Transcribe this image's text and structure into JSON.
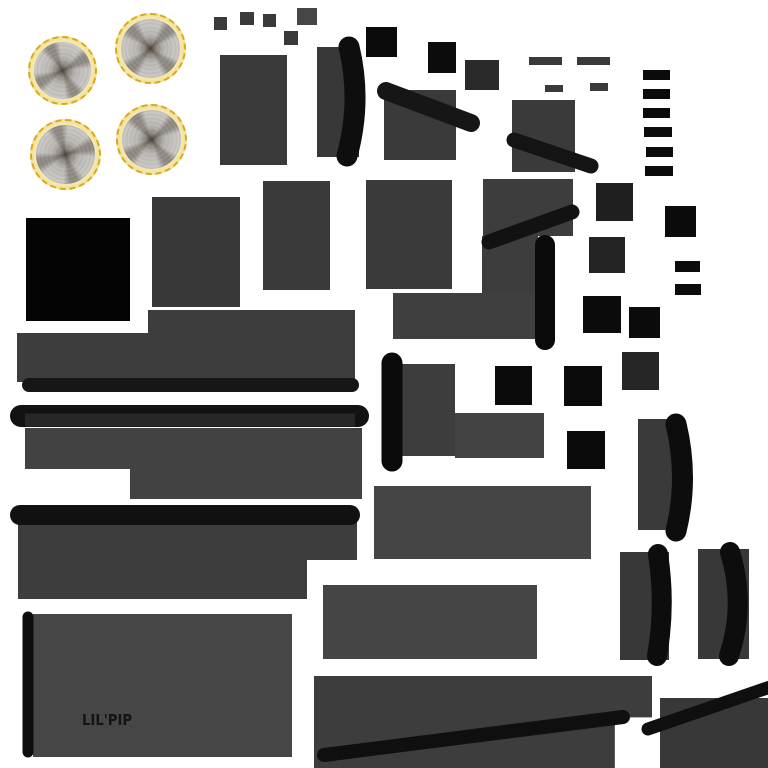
{
  "canvas": {
    "width": 768,
    "height": 768,
    "background": "#ffffff"
  },
  "label": {
    "text": "LIL'PIP",
    "color": "#141414"
  },
  "palette": {
    "panel_gray": "#3a3a3a",
    "panel_mid": "#3d3d3d",
    "panel_light": "#454545",
    "trim_black": "#0f0f0f",
    "wheel_gold": "#d9a91c",
    "wheel_rim": "#f0dc8a",
    "bg": "#ffffff"
  },
  "wheels": [
    {
      "name": "wheel-texture-1",
      "x": 28,
      "y": 36,
      "d": 69,
      "rotate": 12
    },
    {
      "name": "wheel-texture-2",
      "x": 115,
      "y": 13,
      "d": 71,
      "rotate": -6
    },
    {
      "name": "wheel-texture-3",
      "x": 30,
      "y": 119,
      "d": 71,
      "rotate": 22
    },
    {
      "name": "wheel-texture-4",
      "x": 116,
      "y": 104,
      "d": 71,
      "rotate": 3
    }
  ],
  "shapes": [
    {
      "name": "chip-square-1",
      "x": 214,
      "y": 17,
      "w": 13,
      "h": 13,
      "c": "#3a3a3a"
    },
    {
      "name": "chip-square-2",
      "x": 240,
      "y": 12,
      "w": 14,
      "h": 13,
      "c": "#3a3a3a"
    },
    {
      "name": "chip-square-3",
      "x": 263,
      "y": 14,
      "w": 13,
      "h": 13,
      "c": "#3a3a3a"
    },
    {
      "name": "chip-square-4",
      "x": 297,
      "y": 8,
      "w": 20,
      "h": 17,
      "c": "#464646"
    },
    {
      "name": "chip-square-5",
      "x": 284,
      "y": 31,
      "w": 14,
      "h": 14,
      "c": "#3a3a3a"
    },
    {
      "name": "black-square-1",
      "x": 366,
      "y": 27,
      "w": 31,
      "h": 30,
      "c": "#0a0a0a"
    },
    {
      "name": "black-square-2",
      "x": 428,
      "y": 42,
      "w": 28,
      "h": 31,
      "c": "#0c0c0c"
    },
    {
      "name": "dark-square-1",
      "x": 465,
      "y": 60,
      "w": 34,
      "h": 30,
      "c": "#2a2a2a"
    },
    {
      "name": "strip-bar-1",
      "x": 529,
      "y": 57,
      "w": 33,
      "h": 8,
      "c": "#3a3a3a"
    },
    {
      "name": "strip-bar-2",
      "x": 577,
      "y": 57,
      "w": 33,
      "h": 8,
      "c": "#3a3a3a"
    },
    {
      "name": "strip-bar-3",
      "x": 545,
      "y": 85,
      "w": 18,
      "h": 7,
      "c": "#3a3a3a"
    },
    {
      "name": "strip-bar-4",
      "x": 590,
      "y": 83,
      "w": 18,
      "h": 8,
      "c": "#3a3a3a"
    },
    {
      "name": "ladder-bar-1",
      "x": 643,
      "y": 70,
      "w": 27,
      "h": 10,
      "c": "#0b0b0b"
    },
    {
      "name": "ladder-bar-2",
      "x": 643,
      "y": 89,
      "w": 27,
      "h": 10,
      "c": "#0b0b0b"
    },
    {
      "name": "ladder-bar-3",
      "x": 643,
      "y": 108,
      "w": 27,
      "h": 10,
      "c": "#0b0b0b"
    },
    {
      "name": "ladder-bar-4",
      "x": 644,
      "y": 127,
      "w": 28,
      "h": 10,
      "c": "#0b0b0b"
    },
    {
      "name": "ladder-bar-5",
      "x": 646,
      "y": 147,
      "w": 27,
      "h": 10,
      "c": "#0b0b0b"
    },
    {
      "name": "ladder-bar-6",
      "x": 645,
      "y": 166,
      "w": 28,
      "h": 10,
      "c": "#0b0b0b"
    },
    {
      "name": "panel-tall-1",
      "x": 220,
      "y": 55,
      "w": 67,
      "h": 110,
      "c": "#3a3a3a"
    },
    {
      "name": "crescent-panel-top",
      "x": 317,
      "y": 47,
      "w": 42,
      "h": 110,
      "c": "#383838"
    },
    {
      "name": "panel-square-1",
      "x": 384,
      "y": 90,
      "w": 72,
      "h": 70,
      "c": "#3a3a3a"
    },
    {
      "name": "panel-square-2",
      "x": 512,
      "y": 100,
      "w": 63,
      "h": 72,
      "c": "#3a3a3a"
    },
    {
      "name": "dark-square-2",
      "x": 596,
      "y": 183,
      "w": 37,
      "h": 38,
      "c": "#1f1f1f"
    },
    {
      "name": "black-square-3",
      "x": 665,
      "y": 206,
      "w": 31,
      "h": 31,
      "c": "#0b0b0b"
    },
    {
      "name": "dark-square-3",
      "x": 589,
      "y": 237,
      "w": 36,
      "h": 36,
      "c": "#242424"
    },
    {
      "name": "panel-tall-2",
      "x": 152,
      "y": 197,
      "w": 88,
      "h": 110,
      "c": "#383838"
    },
    {
      "name": "black-panel",
      "x": 26,
      "y": 218,
      "w": 104,
      "h": 103,
      "c": "#040404"
    },
    {
      "name": "panel-tall-3",
      "x": 263,
      "y": 181,
      "w": 67,
      "h": 109,
      "c": "#3a3a3a"
    },
    {
      "name": "panel-tall-4",
      "x": 366,
      "y": 180,
      "w": 86,
      "h": 109,
      "c": "#3a3a3a"
    },
    {
      "name": "panel-l-top",
      "x": 483,
      "y": 179,
      "w": 90,
      "h": 57,
      "c": "#3d3d3d"
    },
    {
      "name": "panel-l-stem",
      "x": 482,
      "y": 236,
      "w": 56,
      "h": 102,
      "c": "#3d3d3d"
    },
    {
      "name": "panel-wide-1",
      "x": 393,
      "y": 293,
      "w": 145,
      "h": 46,
      "c": "#3f3f3f"
    },
    {
      "name": "black-square-4",
      "x": 583,
      "y": 296,
      "w": 38,
      "h": 37,
      "c": "#0b0b0b"
    },
    {
      "name": "black-square-5",
      "x": 629,
      "y": 307,
      "w": 31,
      "h": 31,
      "c": "#0b0b0b"
    },
    {
      "name": "black-bar-1",
      "x": 675,
      "y": 261,
      "w": 25,
      "h": 11,
      "c": "#0b0b0b"
    },
    {
      "name": "black-bar-2",
      "x": 675,
      "y": 284,
      "w": 26,
      "h": 11,
      "c": "#0b0b0b"
    },
    {
      "name": "band-step-top",
      "x": 148,
      "y": 310,
      "w": 207,
      "h": 25,
      "c": "#3d3d3d"
    },
    {
      "name": "band-wide-1",
      "x": 17,
      "y": 333,
      "w": 338,
      "h": 49,
      "c": "#3d3d3d"
    },
    {
      "name": "panel-mid-1",
      "x": 391,
      "y": 364,
      "w": 64,
      "h": 92,
      "c": "#3d3d3d"
    },
    {
      "name": "panel-mid-2",
      "x": 455,
      "y": 413,
      "w": 89,
      "h": 45,
      "c": "#434343"
    },
    {
      "name": "black-square-6",
      "x": 495,
      "y": 366,
      "w": 37,
      "h": 39,
      "c": "#0a0a0a"
    },
    {
      "name": "black-square-7",
      "x": 564,
      "y": 366,
      "w": 38,
      "h": 40,
      "c": "#0a0a0a"
    },
    {
      "name": "dark-square-4",
      "x": 622,
      "y": 352,
      "w": 37,
      "h": 38,
      "c": "#262626"
    },
    {
      "name": "crescent-panel-right",
      "x": 638,
      "y": 419,
      "w": 47,
      "h": 111,
      "c": "#3a3a3a"
    },
    {
      "name": "band-wide-2",
      "x": 25,
      "y": 428,
      "w": 337,
      "h": 41,
      "c": "#424242"
    },
    {
      "name": "band-step-bottom",
      "x": 130,
      "y": 469,
      "w": 232,
      "h": 30,
      "c": "#424242"
    },
    {
      "name": "black-square-8",
      "x": 567,
      "y": 431,
      "w": 38,
      "h": 38,
      "c": "#0a0a0a"
    },
    {
      "name": "deck-panel-1",
      "x": 374,
      "y": 486,
      "w": 217,
      "h": 73,
      "c": "#454545"
    },
    {
      "name": "deck-panel-2a",
      "x": 18,
      "y": 519,
      "w": 339,
      "h": 41,
      "c": "#3d3d3d"
    },
    {
      "name": "deck-panel-2b",
      "x": 18,
      "y": 519,
      "w": 289,
      "h": 80,
      "c": "#3d3d3d"
    },
    {
      "name": "deck-panel-3",
      "x": 323,
      "y": 585,
      "w": 214,
      "h": 74,
      "c": "#454545"
    },
    {
      "name": "crescent-panel-a",
      "x": 620,
      "y": 552,
      "w": 49,
      "h": 108,
      "c": "#383838"
    },
    {
      "name": "crescent-panel-b",
      "x": 698,
      "y": 549,
      "w": 51,
      "h": 110,
      "c": "#383838"
    },
    {
      "name": "lilpip-panel",
      "x": 33,
      "y": 614,
      "w": 259,
      "h": 143,
      "c": "#464646"
    },
    {
      "name": "bottom-panel",
      "x": 314,
      "y": 676,
      "w": 338,
      "h": 92,
      "c": "#3d3d3d",
      "clip": "polygon(0 0, 100% 0, 100% 45%, 89% 45%, 89% 100%, 0 100%)"
    },
    {
      "name": "corner-panel",
      "x": 660,
      "y": 698,
      "w": 108,
      "h": 70,
      "c": "#383838"
    }
  ],
  "strokes": [
    {
      "name": "band1-trim-bar",
      "d": "M29 385 L352 385",
      "w": 14,
      "c": "#161616"
    },
    {
      "name": "band2-trim-bar",
      "d": "M21 416 L358 416",
      "w": 22,
      "c": "#121212"
    },
    {
      "name": "band2-trim-inner",
      "d": "M25 420 L355 420",
      "w": 13,
      "c": "#272727",
      "cap": "butt"
    },
    {
      "name": "deck-trim-bar",
      "d": "M20 515 L350 515",
      "w": 20,
      "c": "#111111"
    },
    {
      "name": "lilpip-side-bar",
      "d": "M28 617 L28 752",
      "w": 11,
      "c": "#0d0d0d"
    },
    {
      "name": "crescent-top",
      "d": "M349 47 Q362 101 347 156",
      "w": 21,
      "c": "#0e0e0e"
    },
    {
      "name": "diagonal-bar-1",
      "d": "M386 91 L471 123",
      "w": 18,
      "c": "#161616"
    },
    {
      "name": "diagonal-bar-2",
      "d": "M514 140 L591 166",
      "w": 15,
      "c": "#141414"
    },
    {
      "name": "diagonal-bar-3",
      "d": "M489 242 L572 212",
      "w": 15,
      "c": "#121212"
    },
    {
      "name": "vertical-bar-1",
      "d": "M545 245 L545 340",
      "w": 20,
      "c": "#0a0a0a"
    },
    {
      "name": "vertical-bar-2",
      "d": "M392 363 L392 461",
      "w": 21,
      "c": "#0a0a0a"
    },
    {
      "name": "crescent-right",
      "d": "M676 424 Q689 478 676 531",
      "w": 21,
      "c": "#0d0d0d"
    },
    {
      "name": "crescent-pair-a",
      "d": "M658 554 Q666 605 657 656",
      "w": 20,
      "c": "#0d0d0d"
    },
    {
      "name": "crescent-pair-b",
      "d": "M730 552 Q746 604 729 656",
      "w": 20,
      "c": "#0d0d0d"
    },
    {
      "name": "bottom-diagonal",
      "d": "M324 755 L623 717",
      "w": 14,
      "c": "#0f0f0f"
    },
    {
      "name": "corner-diagonal",
      "d": "M648 729 L770 687",
      "w": 13,
      "c": "#0f0f0f"
    }
  ]
}
